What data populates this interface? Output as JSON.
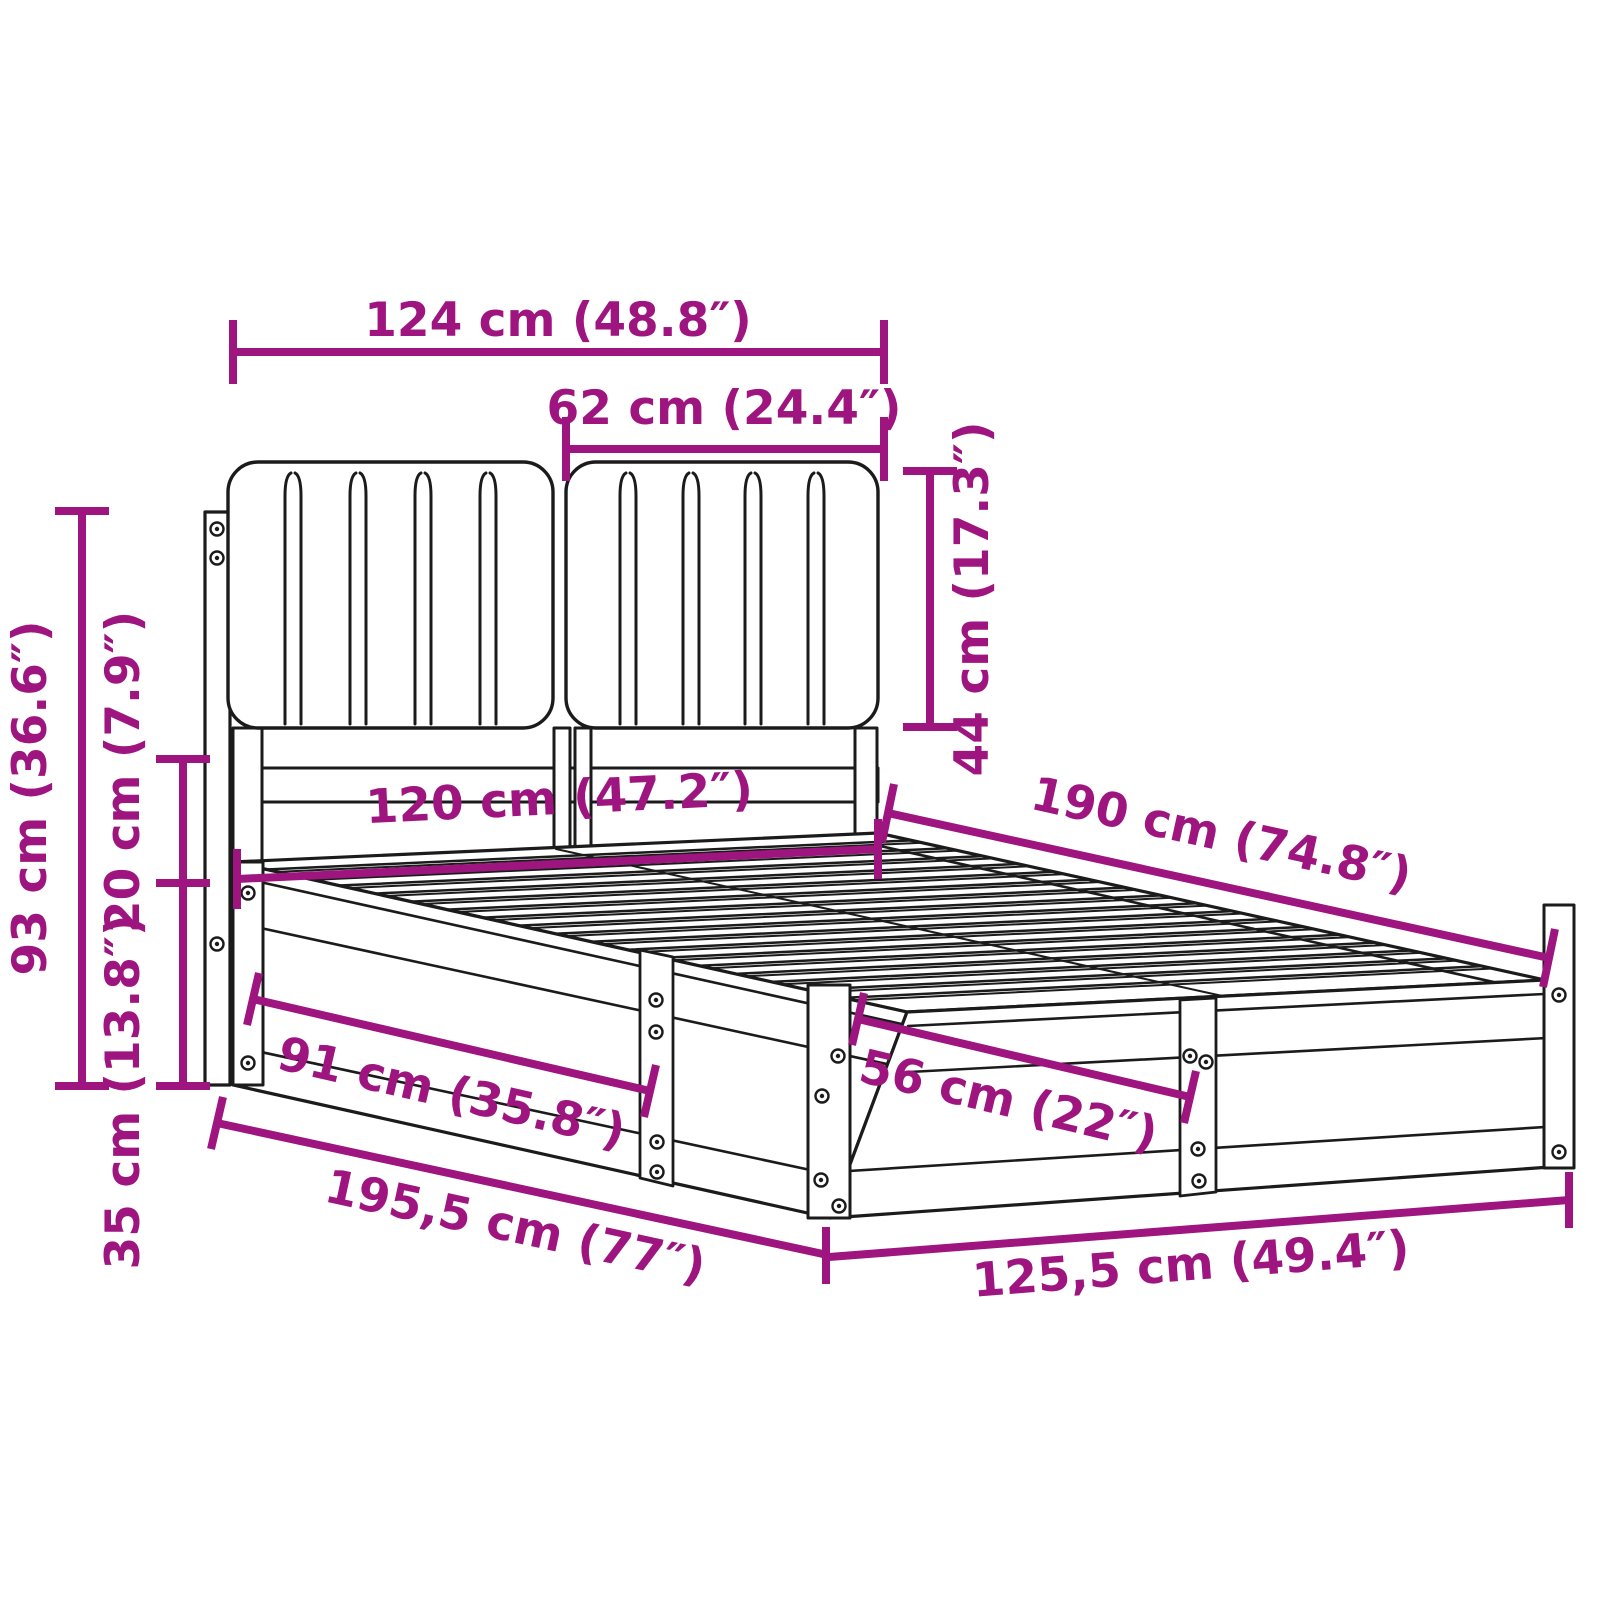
{
  "diagram": {
    "accent_color": "#9e1580",
    "line_color": "#1b1b1b",
    "background_color": "#ffffff",
    "dimensions": [
      {
        "id": "headboard-total-width",
        "label": "124 cm (48.8″)"
      },
      {
        "id": "headboard-cushion-width",
        "label": "62 cm (24.4″)"
      },
      {
        "id": "headboard-cushion-height",
        "label": "44 cm (17.3″)"
      },
      {
        "id": "headboard-total-height",
        "label": "93 cm (36.6″)"
      },
      {
        "id": "cushion-to-base-gap",
        "label": "20 cm (7.9″)"
      },
      {
        "id": "base-frame-height",
        "label": "35 cm (13.8″)"
      },
      {
        "id": "bed-inner-width",
        "label": "120 cm (47.2″)"
      },
      {
        "id": "bed-inner-length",
        "label": "190 cm (74.8″)"
      },
      {
        "id": "side-panel-section",
        "label": "91 cm (35.8″)"
      },
      {
        "id": "foot-panel-section",
        "label": "56 cm (22″)"
      },
      {
        "id": "frame-outer-length",
        "label": "195,5 cm (77″)"
      },
      {
        "id": "frame-outer-width",
        "label": "125,5 cm (49.4″)"
      }
    ]
  }
}
